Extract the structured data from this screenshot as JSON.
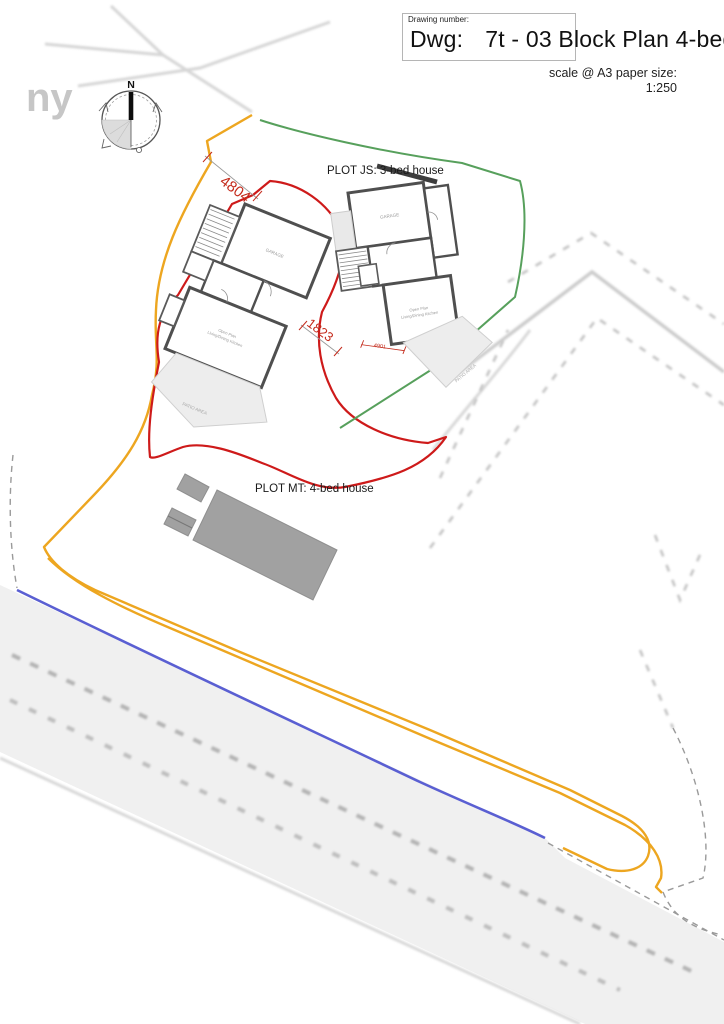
{
  "title_block": {
    "drawing_number_label": "Drawing number:",
    "dwg_label": "Dwg:",
    "drawing_title": "7t - 03 Block Plan 4-bed",
    "scale_label": "scale @ A3 paper size:",
    "scale_value": "1:250"
  },
  "compass": {
    "north_label": "N"
  },
  "plots": {
    "plot_js_label": "PLOT JS: 3-bed house",
    "plot_mt_label": "PLOT MT: 4-bed house"
  },
  "dimensions": {
    "d1": "4804",
    "d2": "1823",
    "d3": "4901"
  },
  "background": {
    "map_text": "ny"
  },
  "rooms": {
    "garage_left": "GARAGE",
    "garage_right": "GARAGE",
    "open_plan_line1": "Open Plan",
    "open_plan_line2": "Living/Dining Kitchen",
    "patio_left": "PATIO AREA",
    "patio_right": "PATIO AREA"
  },
  "colors": {
    "site_boundary_orange": "#EDA620",
    "plot_mt_boundary_red": "#CE1A1A",
    "plot_js_boundary_green": "#57A05C",
    "road_edge_blue": "#5A5FD2",
    "dimension_red": "#C42B1C"
  }
}
